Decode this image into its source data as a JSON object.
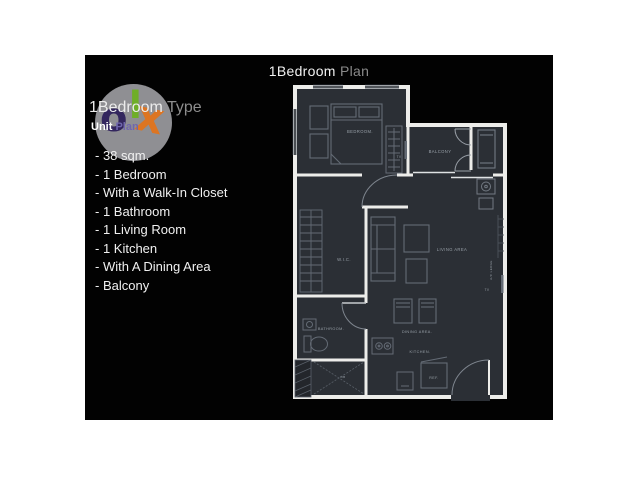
{
  "header": {
    "title_primary": "1Bedroom",
    "title_secondary": " Plan"
  },
  "logo": {
    "circle_color": "#8f8f93",
    "letters": [
      {
        "char": "o",
        "color": "#33265e"
      },
      {
        "char": "l",
        "color": "#6fae28"
      },
      {
        "char": "x",
        "color": "#dd7522"
      }
    ]
  },
  "unit": {
    "type_primary": "1Bedroom",
    "type_secondary": " Type",
    "plan_primary": "Unit",
    "plan_secondary": " Plan"
  },
  "features": [
    "- 38 sqm.",
    "- 1 Bedroom",
    "- With a Walk-In Closet",
    "- 1 Bathroom",
    "- 1 Living Room",
    "- 1 Kitchen",
    "- With A Dining Area",
    "- Balcony"
  ],
  "floor_plan": {
    "labels": {
      "bedroom": "BEDROOM.",
      "balcony": "BALCONY",
      "wic": "W.I.C.",
      "living": "LIVING AREA",
      "bathroom": "BATHROOM.",
      "dining": "DINING AREA.",
      "kitchen": "KITCHEN.",
      "ref": "REF.",
      "tv_bedroom": "TV",
      "tv_living": "TV",
      "ac_ledge": "A/C LEDGE",
      "db": "DB"
    },
    "colors": {
      "room_fill": "#2b2f35",
      "wall": "#ededea",
      "furniture": "#646b75",
      "label": "#98a0a8"
    }
  }
}
